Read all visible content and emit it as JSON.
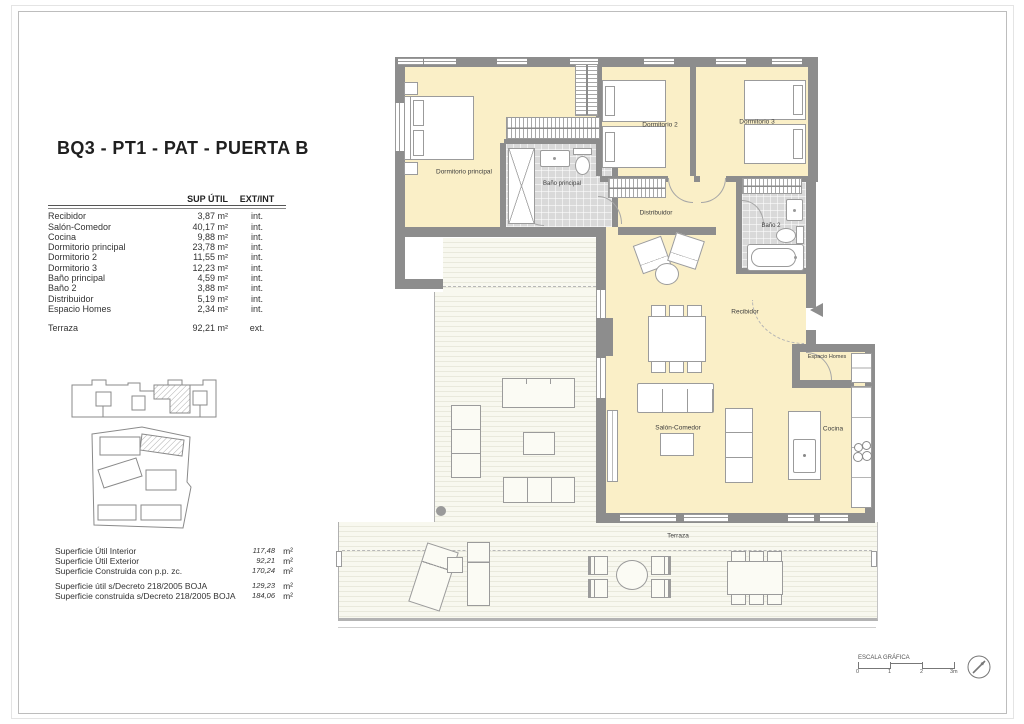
{
  "title": "BQ3 - PT1 - PAT - PUERTA B",
  "table": {
    "headers": {
      "area": "SUP ÚTIL",
      "type": "EXT/INT"
    },
    "rows": [
      {
        "name": "Recibidor",
        "area": "3,87 m²",
        "type": "int."
      },
      {
        "name": "Salón-Comedor",
        "area": "40,17 m²",
        "type": "int."
      },
      {
        "name": "Cocina",
        "area": "9,88 m²",
        "type": "int."
      },
      {
        "name": "Dormitorio principal",
        "area": "23,78 m²",
        "type": "int."
      },
      {
        "name": "Dormitorio 2",
        "area": "11,55 m²",
        "type": "int."
      },
      {
        "name": "Dormitorio 3",
        "area": "12,23 m²",
        "type": "int."
      },
      {
        "name": "Baño principal",
        "area": "4,59 m²",
        "type": "int."
      },
      {
        "name": "Baño 2",
        "area": "3,88 m²",
        "type": "int."
      },
      {
        "name": "Distribuidor",
        "area": "5,19 m²",
        "type": "int."
      },
      {
        "name": "Espacio Homes",
        "area": "2,34 m²",
        "type": "int."
      }
    ],
    "terraza": {
      "name": "Terraza",
      "area": "92,21 m²",
      "type": "ext."
    }
  },
  "summary": {
    "rows": [
      {
        "label": "Superficie Útil Interior",
        "value": "117,48",
        "unit": "m²"
      },
      {
        "label": "Superficie Útil Exterior",
        "value": "92,21",
        "unit": "m²"
      },
      {
        "label": "Superficie Construida con p.p. zc.",
        "value": "170,24",
        "unit": "m²"
      }
    ],
    "rows2": [
      {
        "label": "Superficie útil s/Decreto 218/2005 BOJA",
        "value": "129,23",
        "unit": "m²"
      },
      {
        "label": "Superficie construida s/Decreto 218/2005 BOJA",
        "value": "184,06",
        "unit": "m²"
      }
    ]
  },
  "plan": {
    "labels": {
      "dormitorio_principal": "Dormitorio principal",
      "bano_principal": "Baño principal",
      "dormitorio_2": "Dormitorio 2",
      "dormitorio_3": "Dormitorio 3",
      "distribuidor": "Distribuidor",
      "bano_2": "Baño 2",
      "recibidor": "Recibidor",
      "espacio_homes": "Espacio Homes",
      "salon_comedor": "Salón-Comedor",
      "cocina": "Cocina",
      "terraza": "Terraza"
    }
  },
  "scale_bar": {
    "title": "ESCALA GRÁFICA",
    "ticks": [
      "0",
      "1",
      "2",
      "3m"
    ]
  },
  "colors": {
    "room_fill": "#faefc7",
    "wall": "#8d8d8d",
    "bath_fill": "#d9d9d9",
    "terrace_fill": "#f8f8ef",
    "terrace_stripe": "#e9e9dc"
  }
}
